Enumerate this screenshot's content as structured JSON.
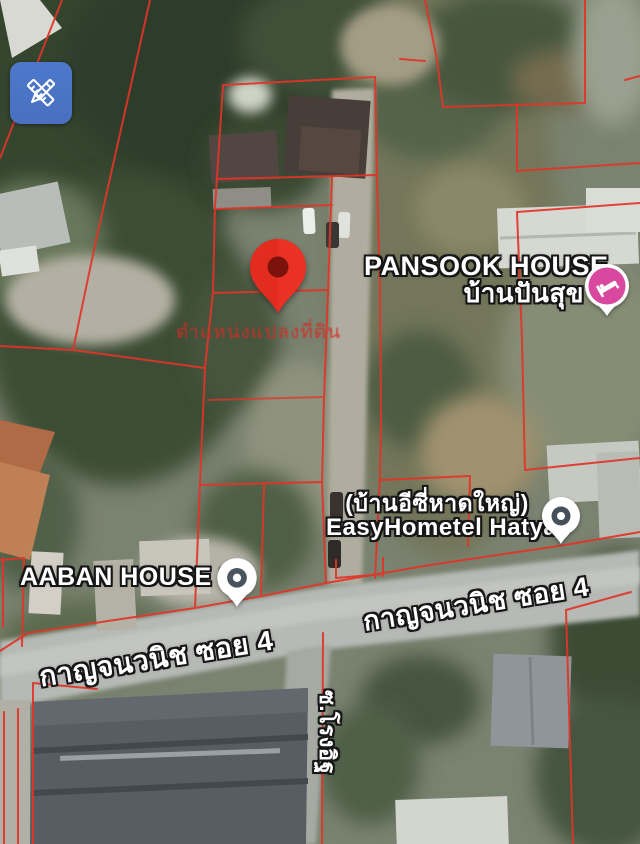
{
  "app": {
    "view": "satellite-map"
  },
  "toolbar": {
    "draw_button_icon": "pencil-ruler-icon"
  },
  "note": {
    "text": "ตำแหน่งแปลงที่ดิน",
    "color": "#d02e26"
  },
  "pois": {
    "pansook": {
      "title": "PANSOOK HOUSE",
      "subtitle": "บ้านปันสุข",
      "pin": "lodging-pin",
      "pin_color": "#d7489e"
    },
    "easyhometel": {
      "title": "(บ้านอีซี่หาดใหญ่)",
      "subtitle": "EasyHometel Hatyai",
      "pin": "generic-place-pin"
    },
    "aaban": {
      "title": "AABAN HOUSE 03",
      "pin": "generic-place-pin"
    }
  },
  "roads": {
    "main_east": "กาญจนวนิช ซอย 4",
    "main_west": "กาญจนวนิช ซอย 4",
    "side": "ซ.โรงอิฐ"
  },
  "overlay": {
    "parcel_line_color": "#e03528",
    "marker": "red-location-pin",
    "marker_color": "#ea3124"
  }
}
